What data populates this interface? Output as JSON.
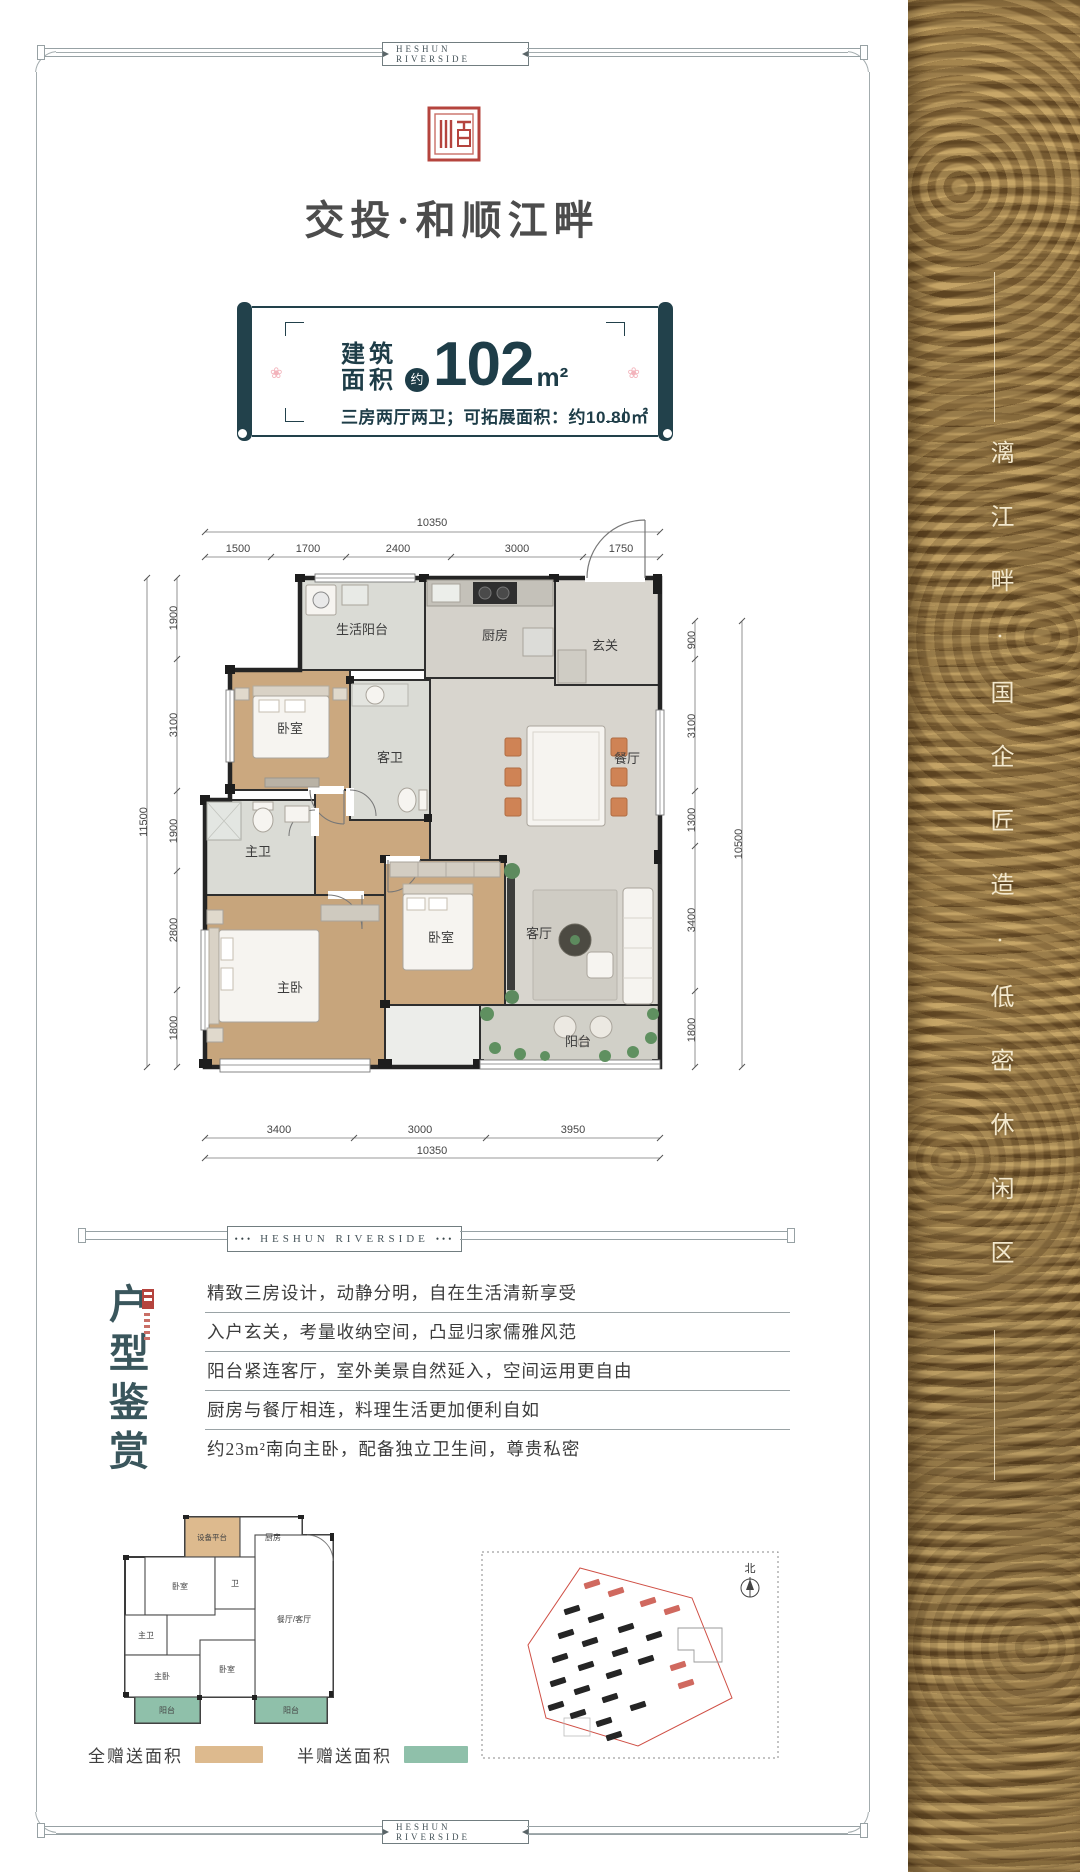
{
  "badges": {
    "top": "HESHUN RIVERSIDE",
    "middle": "HESHUN RIVERSIDE",
    "bottom": "HESHUN RIVERSIDE",
    "middle_dots": "•••"
  },
  "brand": {
    "name": "交投·和顺江畔"
  },
  "area_card": {
    "label_line1": "建筑",
    "label_line2": "面积",
    "approx_badge": "约",
    "value": "102",
    "unit": "m²",
    "subtitle": "三房两厅两卫；可拓展面积：约10.80㎡"
  },
  "floor_plan": {
    "dims_top": {
      "total": "10350",
      "segments": [
        "1500",
        "1700",
        "2400",
        "3000",
        "1750"
      ]
    },
    "dims_left": {
      "total": "11500",
      "segments": [
        "1900",
        "3100",
        "1900",
        "2800",
        "1800"
      ]
    },
    "dims_right": {
      "total": "10500",
      "segments": [
        "900",
        "3100",
        "1300",
        "3400",
        "1800"
      ]
    },
    "dims_bottom": {
      "total": "10350",
      "segments": [
        "3400",
        "3000",
        "3950"
      ]
    },
    "rooms": {
      "service_balcony": "生活阳台",
      "kitchen": "厨房",
      "foyer": "玄关",
      "bedroom": "卧室",
      "guest_bath": "客卫",
      "dining": "餐厅",
      "master_bath": "主卫",
      "master_bedroom": "主卧",
      "bedroom2": "卧室",
      "living": "客厅",
      "balcony": "阳台"
    }
  },
  "appreciation": {
    "title": "户型鉴赏",
    "features": [
      "精致三房设计，动静分明，自在生活清新享受",
      "入户玄关，考量收纳空间，凸显归家儒雅风范",
      "阳台紧连客厅，室外美景自然延入，空间运用更自由",
      "厨房与餐厅相连，料理生活更加便利自如",
      "约23m²南向主卧，配备独立卫生间，尊贵私密"
    ]
  },
  "mini_plan": {
    "rooms": {
      "equipment": "设备平台",
      "kitchen": "厨房",
      "bedroom": "卧室",
      "bath": "卫",
      "dining_living": "餐厅/客厅",
      "master_bath": "主卫",
      "master_bedroom": "主卧",
      "bedroom2": "卧室",
      "balcony_left": "阳台",
      "balcony_right": "阳台"
    },
    "legend": [
      {
        "label": "全赠送面积",
        "color": "#ddba8e"
      },
      {
        "label": "半赠送面积",
        "color": "#8fc0aa"
      }
    ]
  },
  "site_plan": {
    "north": "北"
  },
  "side_banner": {
    "text": "漓江畔·国企匠造·低密休闲区"
  },
  "colors": {
    "accent_dark": "#22414b",
    "seal_red": "#b5443e",
    "gold_base": "#8a6a3c"
  }
}
